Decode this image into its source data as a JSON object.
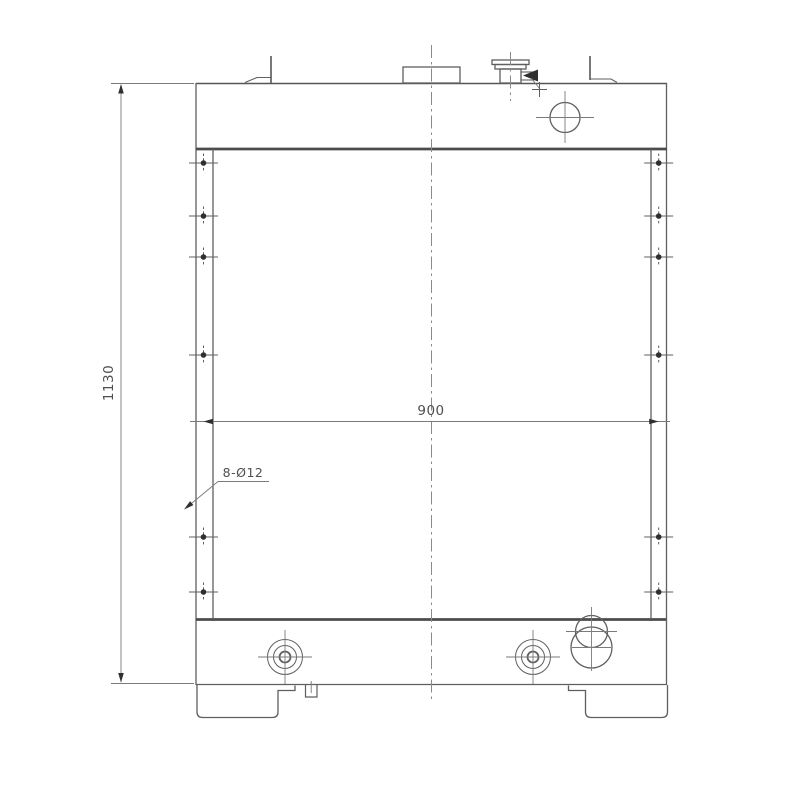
{
  "drawing": {
    "title": "radiator-outline-technical-drawing",
    "labels": {
      "height_dim": "1130",
      "width_dim": "900",
      "holes_note": "8-Ø12"
    },
    "colors": {
      "line": "#5f5f5f",
      "line_light": "#8a8a8a",
      "line_dark": "#4c4c4c",
      "dot": "#2f2f2f",
      "text": "#4f4f4f",
      "background": "#ffffff"
    },
    "holes": {
      "left_x": 203.5,
      "right_x": 658.7,
      "y_positions": [
        163,
        216,
        257,
        355,
        537,
        592
      ]
    }
  }
}
